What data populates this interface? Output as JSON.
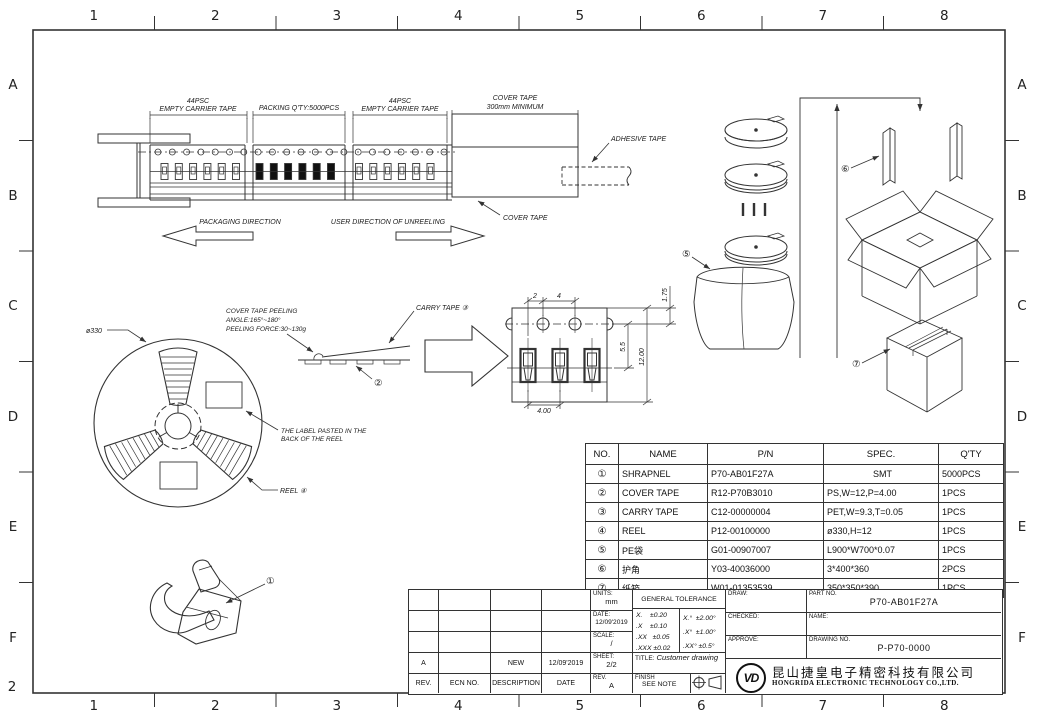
{
  "border": {
    "cols": [
      "1",
      "2",
      "3",
      "4",
      "5",
      "6",
      "7",
      "8"
    ],
    "rows": [
      "A",
      "B",
      "C",
      "D",
      "E",
      "F"
    ],
    "corner_label": "2"
  },
  "tape_diagram": {
    "section1_line1": "44PSC",
    "section1_line2": "EMPTY CARRIER TAPE",
    "packing_qty": "PACKING Q'TY:5000PCS",
    "section3_line1": "44PSC",
    "section3_line2": "EMPTY CARRIER TAPE",
    "cover_tape_line1": "COVER TAPE",
    "cover_tape_line2": "300mm MINIMUM",
    "adhesive_tape": "ADHESIVE TAPE",
    "cover_tape_label": "COVER TAPE",
    "packaging_direction": "PACKAGING DIRECTION",
    "unreeling_direction": "USER DIRECTION OF UNREELING"
  },
  "reel_diagram": {
    "diameter": "ø330",
    "peeling_line1": "COVER TAPE PEELING",
    "peeling_line2": "ANGLE:165°~180°",
    "peeling_line3": "PEELING FORCE:30~130g",
    "carry_tape": "CARRY TAPE ③",
    "callout_2": "②",
    "label_note_line1": "THE LABEL PASTED IN THE",
    "label_note_line2": "BACK OF THE REEL",
    "reel_label": "REEL ④",
    "callout_1": "①"
  },
  "pocket_view": {
    "dim_2": "2",
    "dim_4": "4",
    "dim_175": "1.75",
    "dim_55": "5.5",
    "dim_1200": "12.00",
    "dim_400": "4.00"
  },
  "flow": {
    "callout_5": "⑤",
    "callout_6": "⑥",
    "callout_7": "⑦"
  },
  "parts_table": {
    "headers": [
      "NO.",
      "NAME",
      "P/N",
      "SPEC.",
      "Q'TY"
    ],
    "rows": [
      {
        "no": "①",
        "name": "SHRAPNEL",
        "pn": "P70-AB01F27A",
        "spec": "SMT",
        "qty": "5000PCS"
      },
      {
        "no": "②",
        "name": "COVER TAPE",
        "pn": "R12-P70B3010",
        "spec": "PS,W=12,P=4.00",
        "qty": "1PCS"
      },
      {
        "no": "③",
        "name": "CARRY TAPE",
        "pn": "C12-00000004",
        "spec": "PET,W=9.3,T=0.05",
        "qty": "1PCS"
      },
      {
        "no": "④",
        "name": "REEL",
        "pn": "P12-00100000",
        "spec": "ø330,H=12",
        "qty": "1PCS"
      },
      {
        "no": "⑤",
        "name": "PE袋",
        "pn": "G01-00907007",
        "spec": "L900*W700*0.07",
        "qty": "1PCS"
      },
      {
        "no": "⑥",
        "name": "护角",
        "pn": "Y03-40036000",
        "spec": "3*400*360",
        "qty": "2PCS"
      },
      {
        "no": "⑦",
        "name": "纸箱",
        "pn": "W01-01353539",
        "spec": "350*350*390",
        "qty": "1PCS"
      }
    ]
  },
  "title_block": {
    "rev_table": {
      "headers": [
        "REV.",
        "ECN NO.",
        "DESCRIPTION",
        "DATE"
      ],
      "entry": {
        "rev": "A",
        "ecn": "",
        "description": "NEW",
        "date": "12/09'2019"
      }
    },
    "units_label": "UNITS:",
    "units": "mm",
    "date_label": "DATE:",
    "date": "12/09'2019",
    "scale_label": "SCALE:",
    "scale": "/",
    "sheet_label": "SHEET:",
    "sheet": "2/2",
    "rev_label": "REV.",
    "rev": "A",
    "tolerance": {
      "title": "GENERAL TOLERANCE",
      "linear": [
        "X.    ±0.20",
        ".X    ±0.10",
        ".XX   ±0.05",
        ".XXX ±0.02"
      ],
      "angular": [
        "X.°  ±2.00°",
        ".X°  ±1.00°",
        ".XX° ±0.5°"
      ]
    },
    "title_label": "TITLE:",
    "title": "Customer drawing",
    "finish_label": "FINISH",
    "finish": "SEE NOTE",
    "draw_label": "DRAW:",
    "checked_label": "CHECKED:",
    "approve_label": "APPROVE:",
    "part_no_label": "PART NO.",
    "part_no": "P70-AB01F27A",
    "name_label": "NAME:",
    "drawing_no_label": "DRAWING NO.",
    "drawing_no": "P-P70-0000",
    "logo_text": "VD",
    "company_cn": "昆山捷皇电子精密科技有限公司",
    "company_en": "HONGRIDA ELECTRONIC TECHNOLOGY CO.,LTD."
  }
}
